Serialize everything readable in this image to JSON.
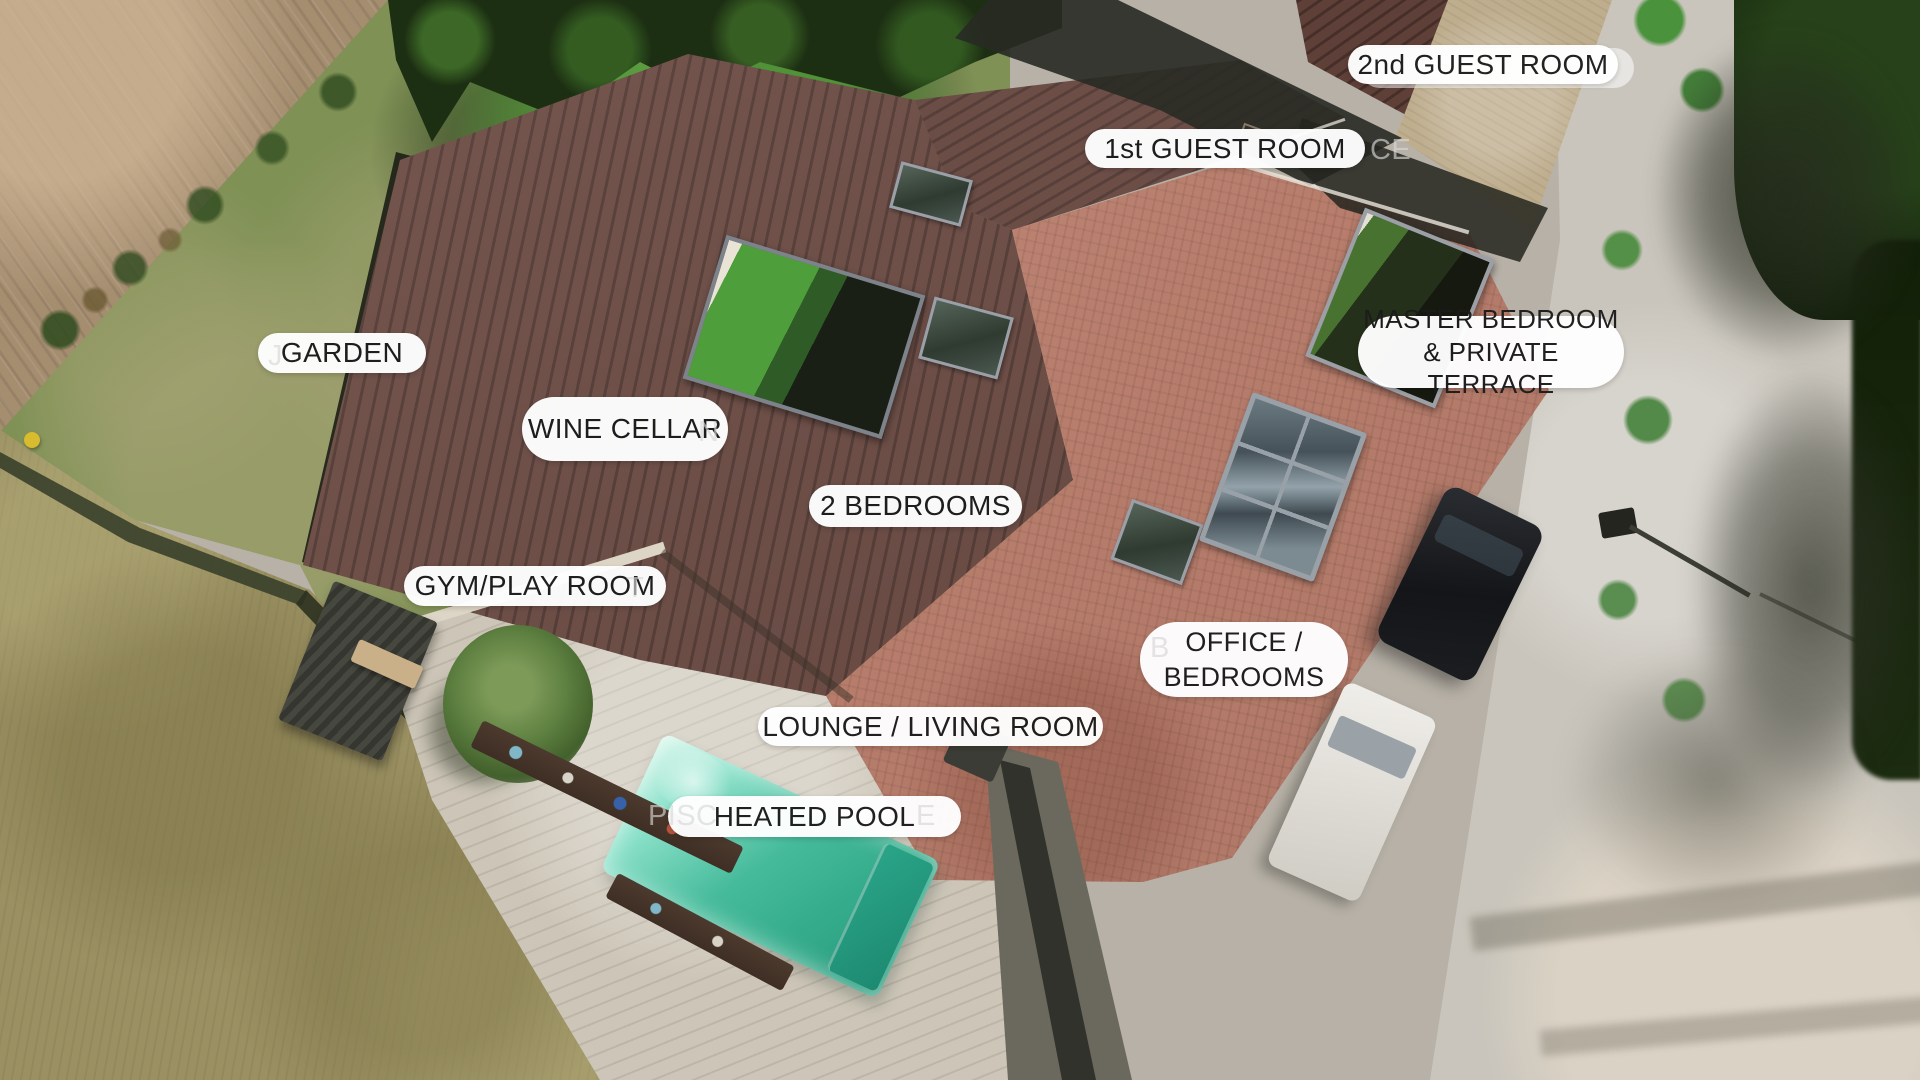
{
  "scene": {
    "description": "Aerial drone photo of a villa property with room labels overlaid",
    "width": 1920,
    "height": 1080
  },
  "labels": [
    {
      "id": "second-guest-room",
      "text": "2nd GUEST ROOM",
      "x": 1348,
      "y": 45,
      "w": 270,
      "h": 39
    },
    {
      "id": "first-guest-room",
      "text": "1st GUEST ROOM",
      "x": 1085,
      "y": 129,
      "w": 280,
      "h": 39
    },
    {
      "id": "garden",
      "text": "GARDEN",
      "x": 258,
      "y": 333,
      "w": 168,
      "h": 40
    },
    {
      "id": "wine-cellar",
      "text": "WINE CELLAR",
      "x": 522,
      "y": 397,
      "w": 206,
      "h": 64
    },
    {
      "id": "two-bedrooms",
      "text": "2 BEDROOMS",
      "x": 809,
      "y": 485,
      "w": 213,
      "h": 42
    },
    {
      "id": "master-bedroom",
      "text": "MASTER BEDROOM\n& PRIVATE TERRACE",
      "x": 1358,
      "y": 316,
      "w": 266,
      "h": 72,
      "fs": 26
    },
    {
      "id": "gym-play-room",
      "text": "GYM/PLAY ROOM",
      "x": 404,
      "y": 566,
      "w": 262,
      "h": 40
    },
    {
      "id": "office-bedrooms",
      "text": "OFFICE /\nBEDROOMS",
      "x": 1140,
      "y": 622,
      "w": 208,
      "h": 75,
      "fs": 27
    },
    {
      "id": "lounge-living-room",
      "text": "LOUNGE / LIVING ROOM",
      "x": 758,
      "y": 707,
      "w": 345,
      "h": 39
    },
    {
      "id": "heated-pool",
      "text": "HEATED POOL",
      "x": 668,
      "y": 796,
      "w": 293,
      "h": 41
    }
  ],
  "ghost_pill": {
    "x": 1360,
    "y": 48,
    "w": 274,
    "h": 40
  },
  "ghost_fragments": [
    {
      "id": "ghost-ce",
      "text": "CE",
      "x": 1370,
      "y": 134
    },
    {
      "id": "ghost-j",
      "text": "J",
      "x": 268,
      "y": 340
    },
    {
      "id": "ghost-n",
      "text": "N",
      "x": 698,
      "y": 416
    },
    {
      "id": "ghost-t",
      "text": "T",
      "x": 626,
      "y": 572
    },
    {
      "id": "ghost-b",
      "text": "B",
      "x": 1150,
      "y": 632
    },
    {
      "id": "ghost-pisc",
      "text": "PISC",
      "x": 648,
      "y": 800
    },
    {
      "id": "ghost-e",
      "text": "E",
      "x": 916,
      "y": 800
    }
  ],
  "colors": {
    "label_bg": "#ffffff",
    "label_text": "#1c1c1c",
    "pool_water": "#46bb9b",
    "pool_light": "#8fe3cc",
    "pool_deep": "#27997c",
    "roof_dark": "#6b4a42",
    "roof_red": "#bf8270",
    "roof_tan": "#bfae8e",
    "deck": "#cdc6b8",
    "lawn": "#7f9155",
    "dirt": "#a58d70",
    "dry_grass": "#9a9062",
    "driveway": "#b7b1a7",
    "road": "#c9c5bc",
    "trees": "#1d2f13",
    "courtyard_grass": "#4f9e3c",
    "car_black": "#141519",
    "van_white": "#f0eeea"
  }
}
